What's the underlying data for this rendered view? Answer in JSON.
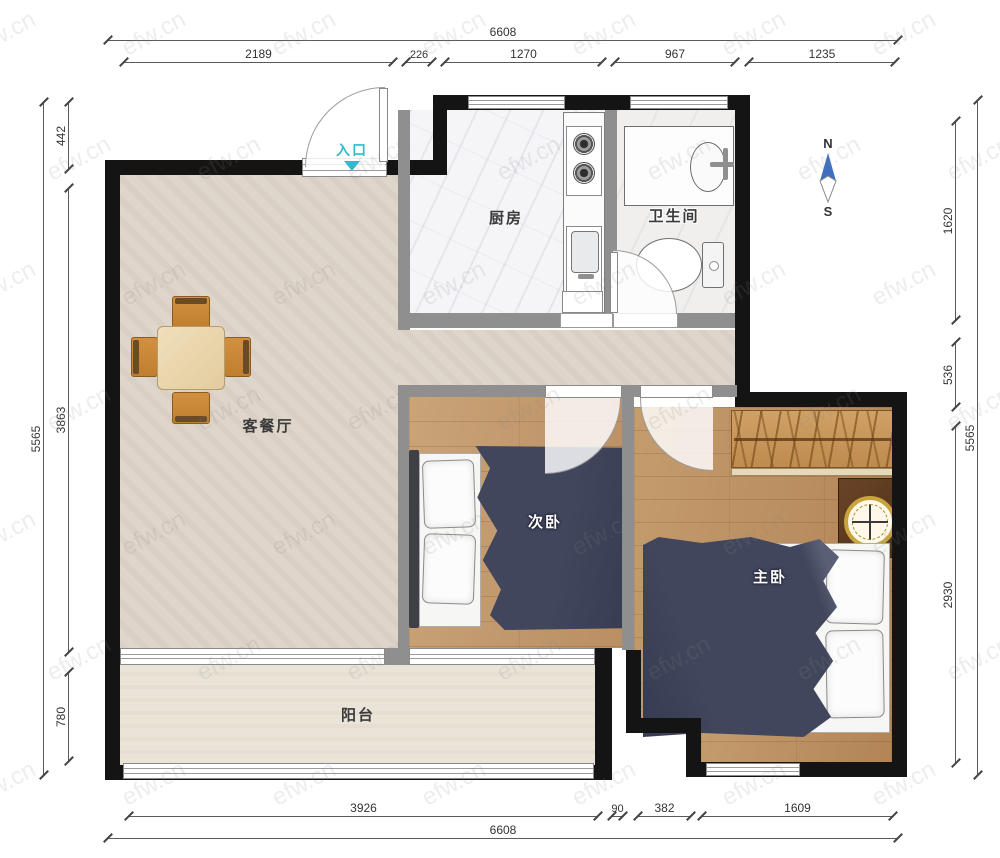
{
  "watermark": {
    "text": "efw.cn"
  },
  "compass": {
    "north": "N",
    "south": "S",
    "arrow_color": "#3f6fbf"
  },
  "rooms": {
    "entrance": {
      "label": "入口"
    },
    "kitchen": {
      "label": "厨房"
    },
    "bathroom": {
      "label": "卫生间"
    },
    "living_dining": {
      "label": "客餐厅"
    },
    "secondary_bedroom": {
      "label": "次卧"
    },
    "master_bedroom": {
      "label": "主卧"
    },
    "balcony": {
      "label": "阳台"
    }
  },
  "dimensions": {
    "top": {
      "total": "6608",
      "segments": [
        "2189",
        "226",
        "1270",
        "967",
        "1235"
      ]
    },
    "bottom": {
      "total": "6608",
      "segments": [
        "3926",
        "90",
        "382",
        "1609"
      ]
    },
    "left": {
      "total": "5565",
      "segments": [
        "442",
        "3863",
        "780"
      ]
    },
    "right": {
      "total": "5565",
      "segments": [
        "1620",
        "536",
        "2930"
      ]
    }
  },
  "colors": {
    "wall": "#141414",
    "partition": "#8f8f8f",
    "bed_blanket": "#3e4257",
    "wood_floor": "#c49c6e",
    "entrance_label": "#35b8cf",
    "compass_arrow": "#3f6fbf"
  }
}
